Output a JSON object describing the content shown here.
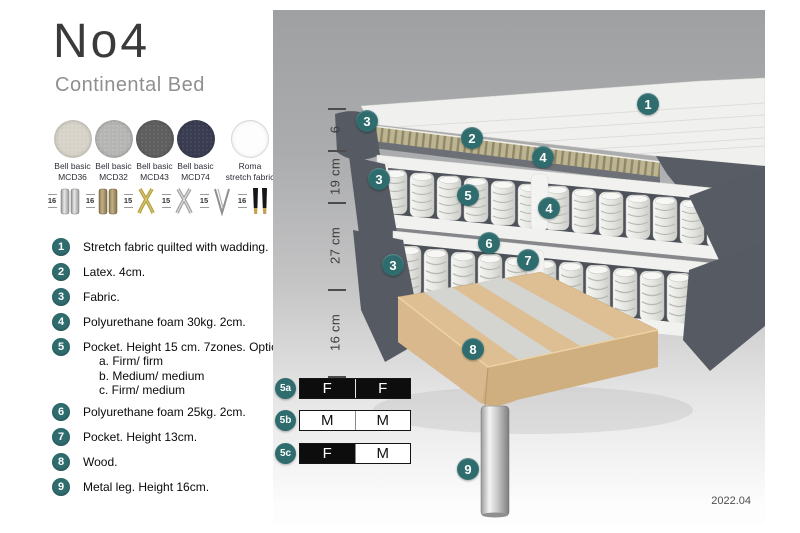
{
  "title": "No4",
  "subtitle": "Continental Bed",
  "colors": {
    "accent_teal": "#2f6c6e",
    "bed_fabric_gray": "#565b63",
    "latex_tan": "#b6ae88",
    "wood": "#ddbf93",
    "swatch_mcd36": "#d6d2c8",
    "swatch_mcd32": "#b5b5b3",
    "swatch_mcd43": "#5f5f5f",
    "swatch_mcd74": "#3a3d52",
    "swatch_roma": "#fdfdfd"
  },
  "swatches": [
    {
      "line1": "Bell basic",
      "line2": "MCD36"
    },
    {
      "line1": "Bell basic",
      "line2": "MCD32"
    },
    {
      "line1": "Bell basic",
      "line2": "MCD43"
    },
    {
      "line1": "Bell basic",
      "line2": "MCD74"
    },
    {
      "line1": "Roma",
      "line2": "stretch fabric"
    }
  ],
  "legs": [
    {
      "size": "16",
      "type": "cylinder-silver"
    },
    {
      "size": "16",
      "type": "cylinder-brass"
    },
    {
      "size": "15",
      "type": "cross-gold"
    },
    {
      "size": "15",
      "type": "cross-silver"
    },
    {
      "size": "15",
      "type": "hairpin-metal"
    },
    {
      "size": "16",
      "type": "black-gold"
    }
  ],
  "list": [
    {
      "num": "1",
      "text": "Stretch fabric quilted with wadding."
    },
    {
      "num": "2",
      "text": "Latex. 4cm."
    },
    {
      "num": "3",
      "text": "Fabric."
    },
    {
      "num": "4",
      "text": "Polyurethane foam 30kg. 2cm."
    },
    {
      "num": "5",
      "text": "Pocket. Height 15 cm. 7zones. Option:",
      "options": [
        "a. Firm/ firm",
        "b. Medium/ medium",
        "c. Firm/ medium"
      ]
    },
    {
      "num": "6",
      "text": "Polyurethane foam 25kg. 2cm."
    },
    {
      "num": "7",
      "text": "Pocket. Height 13cm."
    },
    {
      "num": "8",
      "text": "Wood."
    },
    {
      "num": "9",
      "text": "Metal leg. Height 16cm."
    }
  ],
  "diagram": {
    "measurements": [
      "6",
      "19 cm",
      "27 cm",
      "16 cm"
    ],
    "callouts": [
      {
        "label": "1"
      },
      {
        "label": "2"
      },
      {
        "label": "3"
      },
      {
        "label": "4"
      },
      {
        "label": "3"
      },
      {
        "label": "5"
      },
      {
        "label": "4"
      },
      {
        "label": "6"
      },
      {
        "label": "7"
      },
      {
        "label": "3"
      },
      {
        "label": "8"
      },
      {
        "label": "9"
      }
    ],
    "firmness": [
      {
        "label": "5a",
        "left": "F",
        "right": "F"
      },
      {
        "label": "5b",
        "left": "M",
        "right": "M"
      },
      {
        "label": "5c",
        "left": "F",
        "right": "M"
      }
    ],
    "version": "2022.04"
  }
}
